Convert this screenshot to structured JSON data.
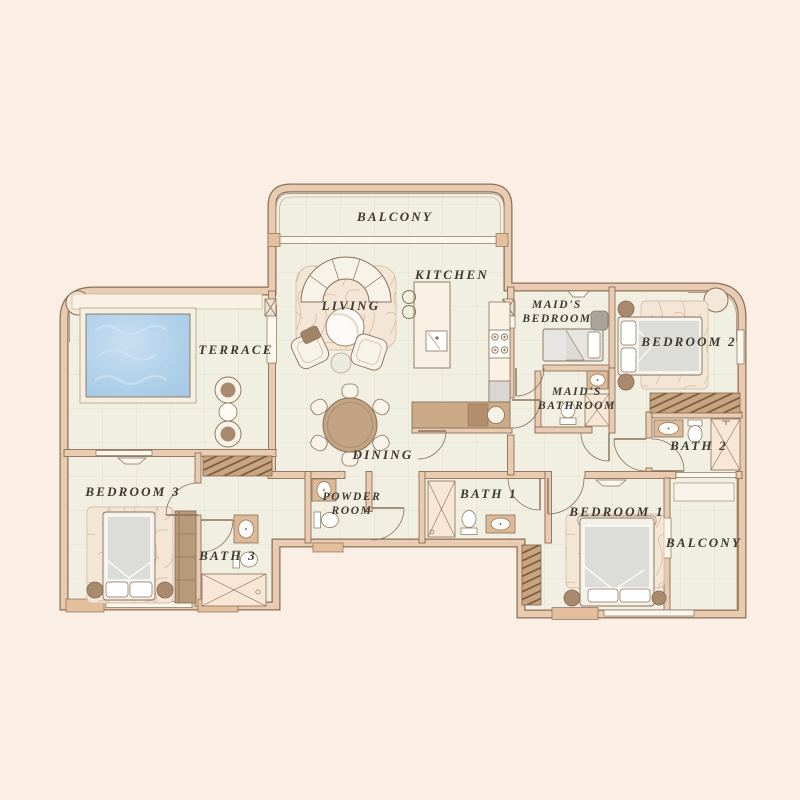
{
  "title": "Residential Unit Floor Plan",
  "rooms": {
    "balcony_top": "BALCONY",
    "living": "LIVING",
    "kitchen": "KITCHEN",
    "terrace": "TERRACE",
    "maids_bedroom_1": "MAID'S",
    "maids_bedroom_2": "BEDROOM",
    "bedroom2": "BEDROOM 2",
    "maids_bathroom_1": "MAID'S",
    "maids_bathroom_2": "BATHROOM",
    "bath2": "BATH 2",
    "dining": "DINING",
    "bedroom3": "BEDROOM 3",
    "powder_1": "POWDER",
    "powder_2": "ROOM",
    "bath1": "BATH 1",
    "bath3": "BATH 3",
    "bedroom1": "BEDROOM 1",
    "balcony_bottom": "BALCONY"
  },
  "palette": {
    "background": "#fbeee4",
    "wall_fill": "#e8cbb0",
    "wall_outline": "#8a7058",
    "floor": "#f0efe2",
    "tile_line": "#e3e1cf",
    "pool_water": "#b3d2ea",
    "wood": "#c2a384",
    "wardrobe_hatch": "#c9a47e",
    "marble_rug": "#f3e6d7",
    "label_text": "#3e3831",
    "fixture_white": "#f7f3e8"
  }
}
